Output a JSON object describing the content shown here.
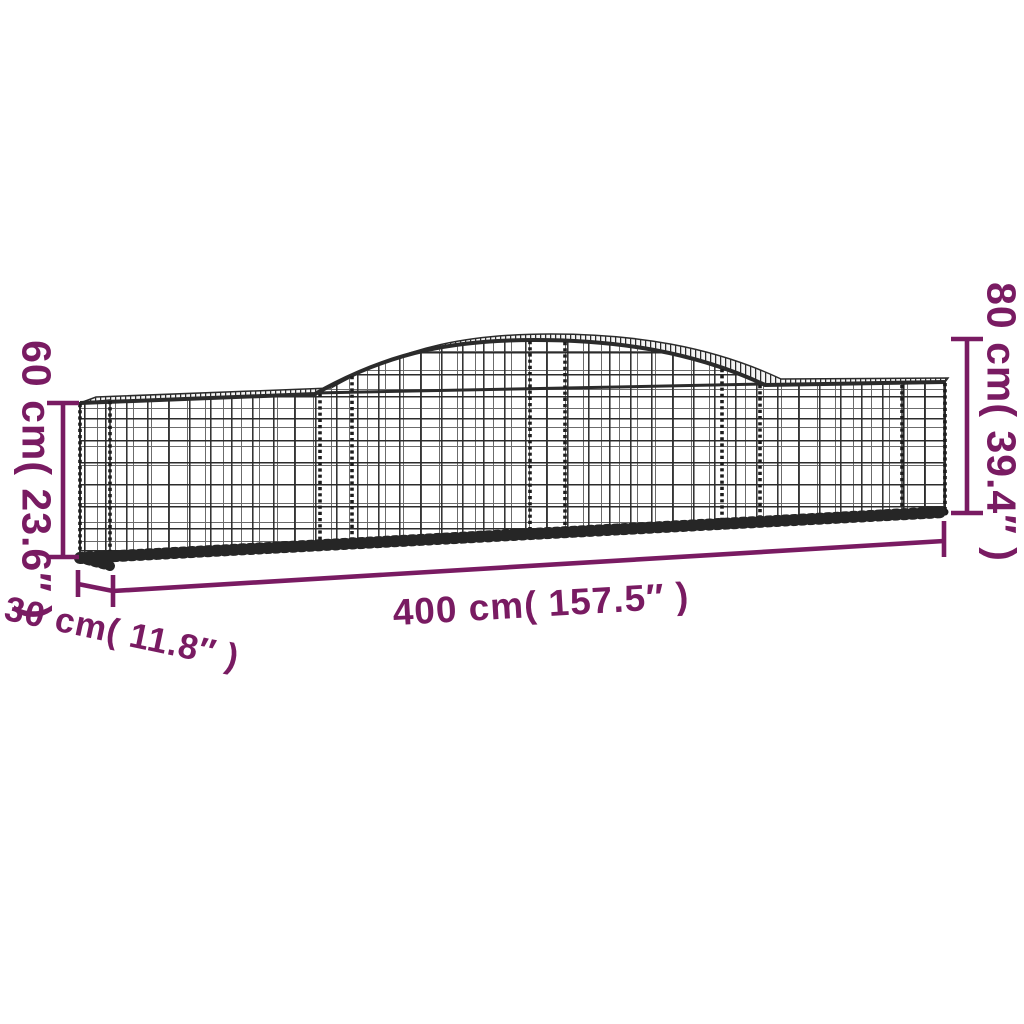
{
  "page": {
    "background": "#FFFFFF"
  },
  "diagram": {
    "subject": "Arched gabion wire mesh basket dimension diagram",
    "dimensions": {
      "height_left": "60 cm( 23.6″ )",
      "height_right": "80 cm( 39.4″ )",
      "length": "400 cm( 157.5″ )",
      "depth": "30 cm( 11.8″ )"
    },
    "colors": {
      "dimension_annotation": "#791B62",
      "mesh_wire_dark": "#2B2B2B",
      "mesh_wire_light": "#6B6B6B",
      "background": "#FFFFFF"
    }
  }
}
